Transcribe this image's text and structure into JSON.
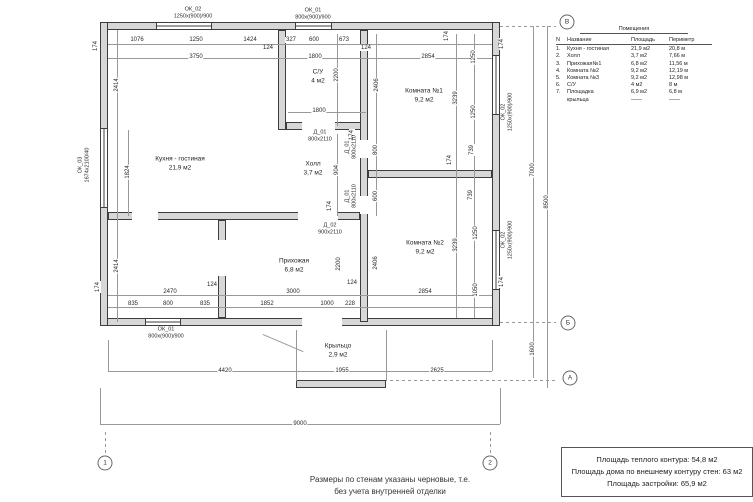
{
  "drawing": {
    "walls": [
      [
        100,
        22,
        400,
        8
      ],
      [
        100,
        318,
        400,
        8
      ],
      [
        100,
        22,
        8,
        304
      ],
      [
        492,
        22,
        8,
        304
      ],
      [
        278,
        30,
        8,
        100
      ],
      [
        286,
        122,
        82,
        8
      ],
      [
        360,
        30,
        8,
        292
      ],
      [
        368,
        170,
        124,
        8
      ],
      [
        108,
        212,
        252,
        8
      ],
      [
        218,
        220,
        8,
        98
      ],
      [
        296,
        380,
        90,
        8
      ]
    ],
    "windows": [
      [
        156,
        22,
        56,
        8,
        "h"
      ],
      [
        295,
        22,
        37,
        8,
        "h"
      ],
      [
        100,
        128,
        8,
        80,
        "v"
      ],
      [
        492,
        55,
        8,
        60,
        "v"
      ],
      [
        492,
        230,
        8,
        60,
        "v"
      ],
      [
        145,
        318,
        36,
        8,
        "h"
      ]
    ],
    "gaps": [
      [
        302,
        122,
        33,
        8
      ],
      [
        298,
        212,
        40,
        8
      ],
      [
        132,
        212,
        26,
        8
      ],
      [
        360,
        140,
        8,
        18
      ],
      [
        360,
        196,
        8,
        18
      ],
      [
        218,
        240,
        8,
        36
      ],
      [
        302,
        318,
        40,
        8
      ]
    ],
    "lines": [
      [
        108,
        44,
        384,
        1
      ],
      [
        108,
        58,
        384,
        1
      ],
      [
        288,
        112,
        78,
        1
      ],
      [
        117,
        30,
        1,
        292
      ],
      [
        128,
        130,
        1,
        86
      ],
      [
        337,
        34,
        1,
        92
      ],
      [
        337,
        134,
        1,
        82
      ],
      [
        376,
        34,
        1,
        182
      ],
      [
        474,
        34,
        1,
        284
      ],
      [
        456,
        34,
        1,
        284
      ],
      [
        108,
        295,
        384,
        1
      ],
      [
        108,
        307,
        384,
        1
      ],
      [
        108,
        371,
        384,
        1
      ],
      [
        100,
        424,
        400,
        1
      ],
      [
        533,
        26,
        1,
        352
      ],
      [
        547,
        26,
        1,
        362
      ],
      [
        296,
        330,
        1,
        51
      ],
      [
        386,
        330,
        1,
        51
      ],
      [
        100,
        388,
        1,
        36
      ],
      [
        500,
        388,
        1,
        36
      ],
      [
        108,
        340,
        1,
        31
      ],
      [
        492,
        340,
        1,
        31
      ],
      [
        263,
        334,
        44,
        1,
        23
      ],
      [
        500,
        26,
        56,
        1,
        "d"
      ],
      [
        500,
        322,
        56,
        1,
        "d"
      ],
      [
        390,
        380,
        168,
        1,
        "d"
      ],
      [
        105,
        432,
        1,
        24,
        "d"
      ],
      [
        490,
        432,
        1,
        24,
        "d"
      ]
    ],
    "dims": [
      [
        "1076",
        137,
        40,
        0
      ],
      [
        "1250",
        196,
        40,
        0
      ],
      [
        "1424",
        250,
        40,
        0
      ],
      [
        "327",
        291,
        40,
        0
      ],
      [
        "600",
        314,
        40,
        0
      ],
      [
        "673",
        344,
        40,
        0
      ],
      [
        "124",
        268,
        48,
        0
      ],
      [
        "124",
        366,
        48,
        0
      ],
      [
        "3750",
        196,
        57,
        0
      ],
      [
        "1800",
        315,
        57,
        0
      ],
      [
        "2854",
        428,
        57,
        0
      ],
      [
        "174",
        96,
        46,
        1
      ],
      [
        "174",
        447,
        36,
        1
      ],
      [
        "174",
        502,
        44,
        1
      ],
      [
        "2414",
        117,
        85,
        1
      ],
      [
        "1824",
        128,
        172,
        1
      ],
      [
        "2414",
        117,
        266,
        1
      ],
      [
        "174",
        98,
        287,
        1
      ],
      [
        "2200",
        337,
        75,
        1
      ],
      [
        "1800",
        319,
        111,
        0
      ],
      [
        "2406",
        377,
        85,
        1
      ],
      [
        "1250",
        474,
        57,
        1
      ],
      [
        "1250",
        474,
        112,
        1
      ],
      [
        "739",
        472,
        150,
        1
      ],
      [
        "3239",
        456,
        98,
        1
      ],
      [
        "904",
        337,
        170,
        1
      ],
      [
        "800",
        376,
        150,
        1
      ],
      [
        "600",
        376,
        196,
        1
      ],
      [
        "174",
        352,
        135,
        1
      ],
      [
        "174",
        330,
        206,
        1
      ],
      [
        "174",
        450,
        160,
        1
      ],
      [
        "739",
        471,
        195,
        1
      ],
      [
        "1250",
        476,
        233,
        1
      ],
      [
        "3239",
        456,
        245,
        1
      ],
      [
        "2406",
        376,
        263,
        1
      ],
      [
        "1050",
        476,
        290,
        1
      ],
      [
        "174",
        502,
        282,
        1
      ],
      [
        "2200",
        339,
        264,
        1
      ],
      [
        "124",
        352,
        283,
        0
      ],
      [
        "124",
        212,
        285,
        0
      ],
      [
        "2470",
        170,
        292,
        0
      ],
      [
        "3000",
        293,
        292,
        0
      ],
      [
        "2854",
        425,
        292,
        0
      ],
      [
        "835",
        133,
        304,
        0
      ],
      [
        "800",
        168,
        304,
        0
      ],
      [
        "835",
        205,
        304,
        0
      ],
      [
        "1852",
        267,
        304,
        0
      ],
      [
        "1000",
        327,
        304,
        0
      ],
      [
        "228",
        350,
        304,
        0
      ],
      [
        "4420",
        225,
        371,
        0
      ],
      [
        "1955",
        342,
        371,
        0
      ],
      [
        "2625",
        437,
        371,
        0
      ],
      [
        "9000",
        300,
        424,
        0
      ],
      [
        "7000",
        533,
        170,
        1
      ],
      [
        "8500",
        547,
        202,
        1
      ],
      [
        "1600",
        533,
        349,
        1
      ]
    ],
    "marks": [
      [
        "ОК_02",
        "1250х(900)/900",
        193,
        13,
        0
      ],
      [
        "ОК_01",
        "800х(900)/900",
        313,
        14,
        0
      ],
      [
        "ОК_03",
        "1674х2100/40",
        84,
        165,
        1
      ],
      [
        "ОК_02",
        "1250х(900)/900",
        507,
        112,
        1
      ],
      [
        "ОК_02",
        "1250х(900)/900",
        507,
        240,
        1
      ],
      [
        "ОК_01",
        "800х(900)/900",
        166,
        333,
        0
      ],
      [
        "Д_01",
        "800х2110",
        320,
        136,
        0
      ],
      [
        "Д_01",
        "800х2110",
        351,
        147,
        1
      ],
      [
        "Д_01",
        "800х2110",
        351,
        196,
        1
      ],
      [
        "Д_02",
        "900х2110",
        330,
        229,
        0
      ]
    ],
    "rooms": [
      [
        "Кухня - гостиная",
        "21,9 м2",
        180,
        164
      ],
      [
        "С/У",
        "4 м2",
        318,
        77
      ],
      [
        "Комната №1",
        "9,2 м2",
        424,
        96
      ],
      [
        "Холл",
        "3,7 м2",
        313,
        169
      ],
      [
        "Комната №2",
        "9,2 м2",
        425,
        248
      ],
      [
        "Прихожая",
        "6,8 м2",
        294,
        266
      ],
      [
        "Крыльцо",
        "2,9 м2",
        338,
        351
      ]
    ],
    "bubbles": [
      [
        "В",
        567,
        22
      ],
      [
        "Б",
        568,
        323
      ],
      [
        "А",
        570,
        378
      ],
      [
        "1",
        105,
        463
      ],
      [
        "2",
        490,
        463
      ]
    ]
  },
  "table": {
    "title": "Помещения",
    "headers": [
      "N",
      "Название",
      "Площадь",
      "Периметр"
    ],
    "rows": [
      [
        "1.",
        "Кухня - гостиная",
        "21,9 м2",
        "20,8 м"
      ],
      [
        "2.",
        "Холл",
        "3,7 м2",
        "7,66 м"
      ],
      [
        "3.",
        "Прихожая№1",
        "6,8 м2",
        "11,56 м"
      ],
      [
        "4.",
        "Комната №2",
        "9,2 м2",
        "12,19 м"
      ],
      [
        "5.",
        "Комната №3",
        "9,2 м2",
        "12,98 м"
      ],
      [
        "6.",
        "С/У",
        "4 м2",
        "8 м"
      ],
      [
        "7.",
        "Площадка",
        "6,9 м2",
        "6,8 м"
      ],
      [
        "",
        "крыльца",
        "——",
        "——"
      ]
    ]
  },
  "notes": {
    "line1": "Размеры по стенам указаны черновые, т.е.",
    "line2": "без учета внутренней отделки"
  },
  "summary": {
    "line1": "Площадь теплого контура: 54,8 м2",
    "line2": "Площадь дома по внешнему контуру стен: 63 м2",
    "line3": "Площадь застройки: 65,9 м2"
  },
  "colors": {
    "wall_fill": "#d7d7d7",
    "line": "#3d3d3d",
    "dim_line": "#999999",
    "text": "#222222"
  }
}
